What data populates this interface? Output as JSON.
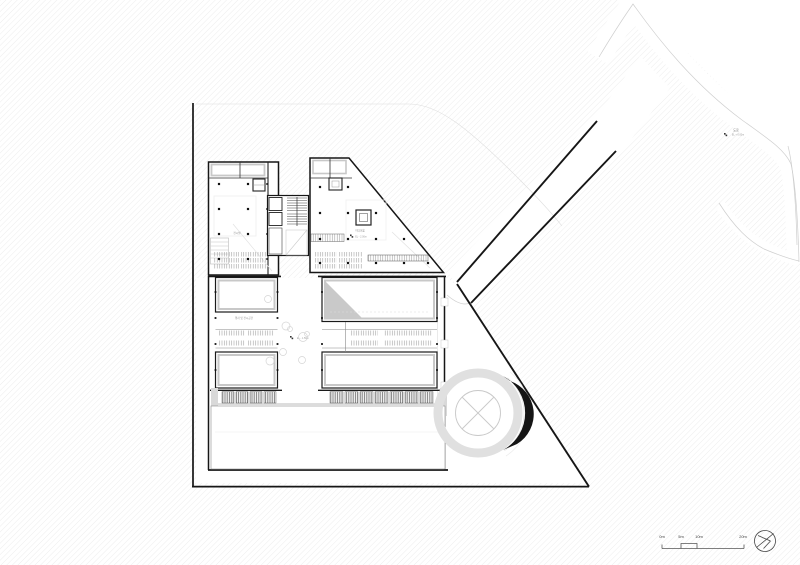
{
  "drawing": {
    "labels": {
      "upper_left_room": "전시실",
      "upper_right_room": "미디어홀",
      "upper_right_level": "EL - 2.00m",
      "lower_left_room": "행사 및 전시공간",
      "walkway_level": "EL - 1.50m",
      "road_name": "도로",
      "road_level": "EL + 0.00m"
    },
    "scale_bar": {
      "ticks": [
        "0m",
        "5m",
        "10m",
        "20m"
      ]
    },
    "colors": {
      "line_dark": "#161616",
      "line_light": "#c9c9c9",
      "hatch": "#ebebeb",
      "fill_gray": "#c9c9c9",
      "text_gray": "#777777"
    }
  }
}
